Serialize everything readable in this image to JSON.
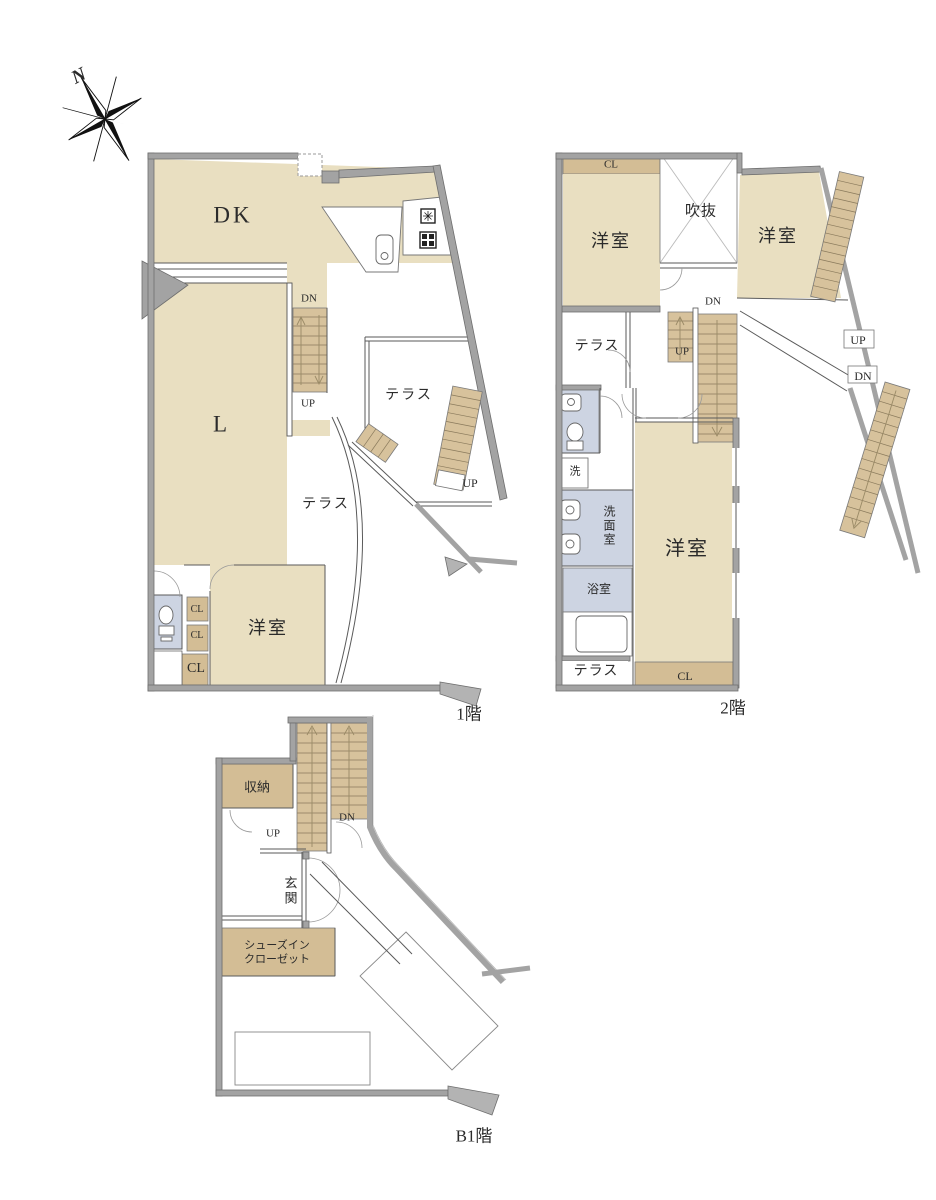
{
  "compass": {
    "north_label": "N"
  },
  "floor_labels": {
    "f1": "1階",
    "f2": "2階",
    "b1": "B1階"
  },
  "colors": {
    "room_fill": "#e9dfc1",
    "closet_fill": "#d3bd95",
    "stair_fill": "#d7c29c",
    "bath_fill": "#cdd4e2",
    "wall_fill": "#a3a3a3",
    "line": "#555555"
  },
  "f1": {
    "dk": "DK",
    "living": "L",
    "terrace_upper": "テラス",
    "terrace_lower": "テラス",
    "bedroom": "洋室",
    "cl_a": "CL",
    "cl_b": "CL",
    "cl_c": "CL",
    "stair_dn": "DN",
    "stair_up": "UP",
    "outer_stair_up": "UP"
  },
  "f2": {
    "cl_top": "CL",
    "bedroom_nw": "洋室",
    "void_space": "吹抜",
    "bedroom_ne": "洋室",
    "terrace_mid": "テラス",
    "stair_dn": "DN",
    "stair_up": "UP",
    "outer_stair_up": "UP",
    "outer_stair_dn": "DN",
    "laundry": "洗",
    "washroom": "洗面室",
    "bathroom": "浴室",
    "bedroom_main": "洋室",
    "cl_bottom": "CL",
    "terrace_bottom": "テラス"
  },
  "b1": {
    "storage": "収納",
    "stair_up": "UP",
    "stair_dn": "DN",
    "entrance": "玄関",
    "shoe_closet_line1": "シューズイン",
    "shoe_closet_line2": "クローゼット"
  }
}
